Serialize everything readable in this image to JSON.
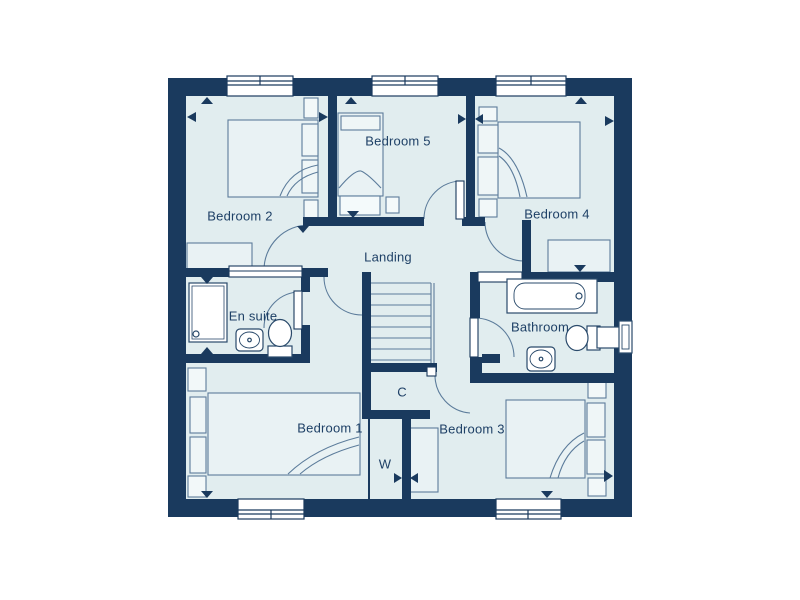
{
  "floorplan": {
    "title": "First floor plan",
    "rooms": [
      {
        "id": "bedroom-2",
        "label": "Bedroom 2"
      },
      {
        "id": "bedroom-5",
        "label": "Bedroom 5"
      },
      {
        "id": "bedroom-4",
        "label": "Bedroom 4"
      },
      {
        "id": "landing",
        "label": "Landing"
      },
      {
        "id": "en-suite",
        "label": "En suite"
      },
      {
        "id": "bathroom",
        "label": "Bathroom"
      },
      {
        "id": "bedroom-1",
        "label": "Bedroom 1"
      },
      {
        "id": "bedroom-3",
        "label": "Bedroom 3"
      },
      {
        "id": "cupboard",
        "label": "C"
      },
      {
        "id": "wardrobe",
        "label": "W"
      }
    ],
    "fixtures": [
      "bed-icon",
      "window-icon",
      "door-arc-icon",
      "stairs-icon",
      "bath-icon",
      "shower-icon",
      "toilet-icon",
      "sink-icon",
      "wardrobe-icon",
      "flue-icon",
      "dimension-arrow-icon"
    ],
    "colors": {
      "wall": "#1A3A5E",
      "floor": "#E1EDEF",
      "furniture_fill": "#E9F2F4",
      "line": "#5C7C9B",
      "fixture_white": "#FFFFFF",
      "label_text": "#1E4066"
    }
  }
}
